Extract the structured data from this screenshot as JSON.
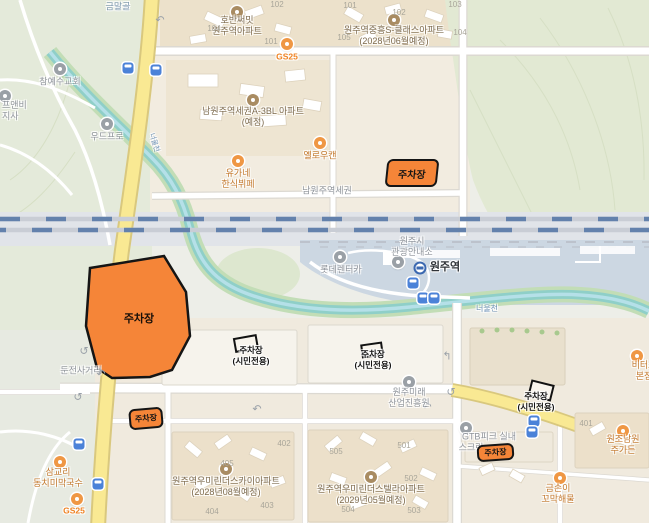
{
  "parking": {
    "label": "주차장",
    "civilian": "(시민전용)"
  },
  "places": {
    "geummalgol": "금말골",
    "church": "참예수교회",
    "chefnb_1": "프앤비",
    "chefnb_2": "지사",
    "woodpro": "우드프로",
    "hoban_1": "호반써밋",
    "hoban_2": "원주역아파트",
    "gs25_top": "GS25",
    "jungheung_1": "원주역중흥S-클래스아파트",
    "jungheung_2": "(2028년06월예정)",
    "a3bl_1": "남원주역세권A-3BL 아파트",
    "a3bl_2": "(예정)",
    "yellowcan": "옐로우캔",
    "yugane_1": "유가네",
    "yugane_2": "한식뷔페",
    "namwonju_road": "남원주역세권",
    "lotte_rentacar": "롯데렌터카",
    "tourist_1": "원주시",
    "tourist_2": "관광안내소",
    "wonju_station": "원주역",
    "river": "너울천",
    "dunjeon": "둔전사거리",
    "mirae_1": "원주미래",
    "mirae_2": "산업진흥원",
    "sky_apt_1": "원주역우미린더스카이아파트",
    "sky_apt_2": "(2028년08월예정)",
    "stella_apt_1": "원주역우미린더스텔라아파트",
    "stella_apt_2": "(2029년05월예정)",
    "gtb_1": "GTB피크 실내",
    "gtb_2": "스크린",
    "biteos_1": "비터스",
    "biteos_2": "본점",
    "namwon_1": "원조남원",
    "namwon_2": "주가든",
    "geumsoni_1": "금손이",
    "geumsoni_2": "꼬막해물",
    "samgyori_1": "삼교리",
    "samgyori_2": "동치미막국수",
    "gs25_bottom": "GS25"
  },
  "block_numbers": [
    "102",
    "104",
    "101",
    "101",
    "102",
    "103",
    "105",
    "104",
    "401",
    "402",
    "403",
    "404",
    "405",
    "501",
    "502",
    "503",
    "504",
    "505"
  ],
  "colors": {
    "parking_fill": "#f58538",
    "parking_border": "#151515",
    "road_yellow": "#f9e993",
    "river": "#8fcfc8",
    "rail_blue": "#6381ac",
    "station_area": "#ccd7e2"
  }
}
